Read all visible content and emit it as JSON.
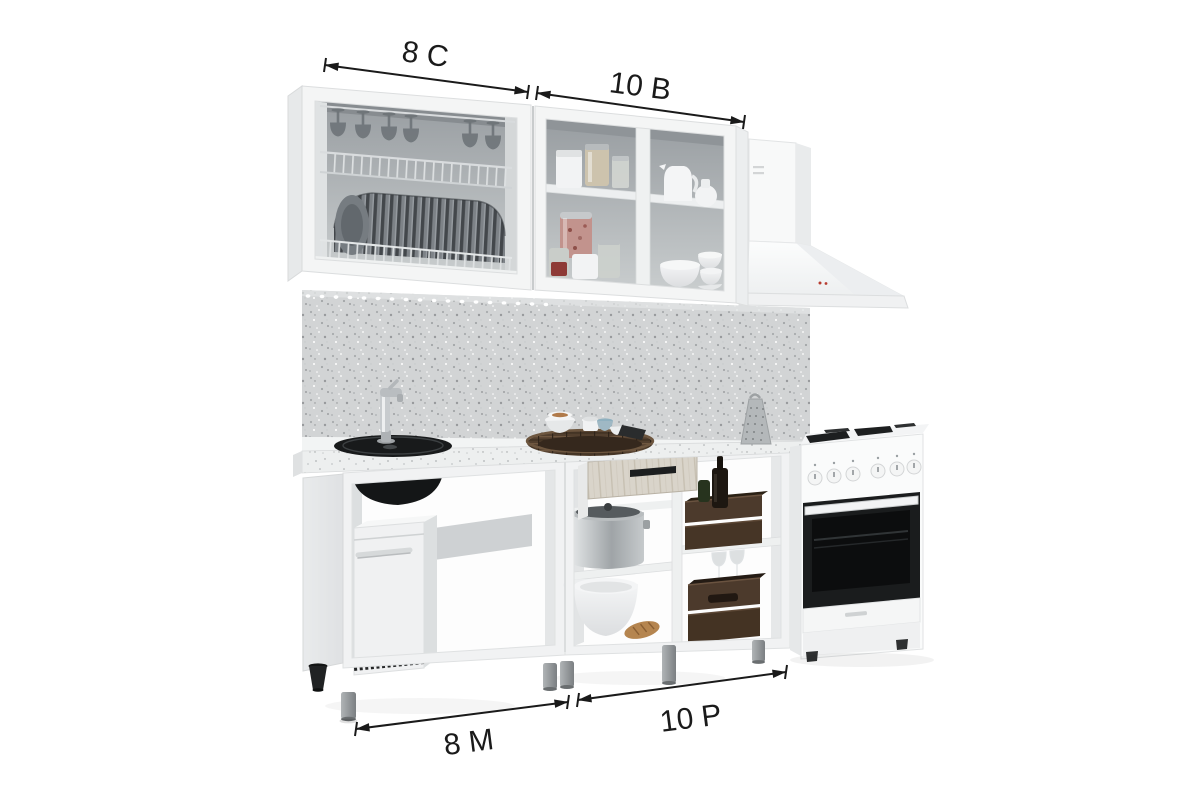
{
  "image_type": "kitchen-set-product-render-with-dimension-callouts",
  "dimensions": {
    "top_left": "8 С",
    "top_right": "10 В",
    "bottom_left": "8 М",
    "bottom_right": "10 Р"
  },
  "colors": {
    "background": "#ffffff",
    "annotation": "#1a1a1a",
    "cabinet_white": "#f4f5f5",
    "cabinet_side": "#e7e9ea",
    "interior_gray_top": "#989da1",
    "interior_gray_bottom": "#c9cdce",
    "backsplash_gray": "#d2d4d5",
    "countertop_speckle": "#edefef",
    "sink_black": "#181a1b",
    "oven_black": "#1a1c1d",
    "crate_wood": "#4c3a2c",
    "drawer_wood": "#d9d4ca",
    "basket_wicker": "#523f2e",
    "leg_gray": "#8f9497",
    "hood_indicator_red": "#b73c30",
    "plate_dark": "#43474b"
  },
  "scene_objects": [
    "wall-cabinet-dish-rack",
    "wall-cabinet-open-shelves",
    "range-hood",
    "backsplash-panel",
    "countertop",
    "sink",
    "faucet",
    "wicker-basket",
    "box-grater",
    "base-cabinet-sink",
    "mini-fridge",
    "open-drawer",
    "stock-pot",
    "mixing-bowls",
    "wooden-crates",
    "freestanding-cooker"
  ]
}
